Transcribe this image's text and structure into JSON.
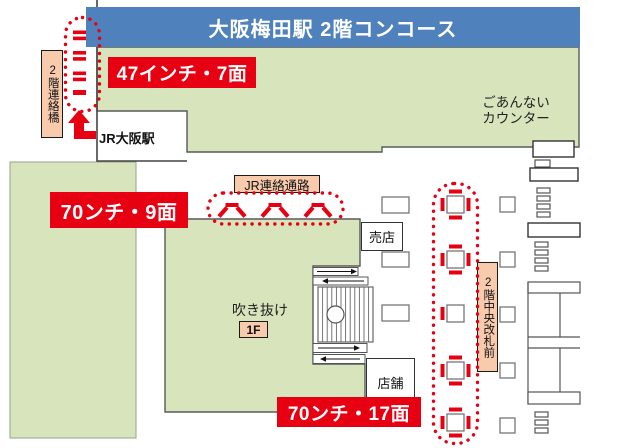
{
  "banner": {
    "title": "大阪梅田駅 2階コンコース"
  },
  "signs": {
    "inch47": "47インチ・7面",
    "inch70_9": "70ンチ・9面",
    "inch70_17": "70ンチ・17面"
  },
  "areas": {
    "bridge": "2階連絡橋",
    "jr_osaka": "JR大阪駅",
    "info_counter": [
      "ごあんない",
      "カウンター"
    ],
    "jr_passage": "JR連絡通路",
    "central_gate": "2階中央改札前",
    "atrium": "吹き抜け",
    "floor_1f": "1F",
    "kiosk": "売店",
    "shop": "店舗"
  },
  "colors": {
    "banner_blue": "#4f81bd",
    "floor_green": "#d8e4bc",
    "sign_red": "#e60012",
    "label_beige": "#f8cbad",
    "outline_gray": "#595959"
  }
}
